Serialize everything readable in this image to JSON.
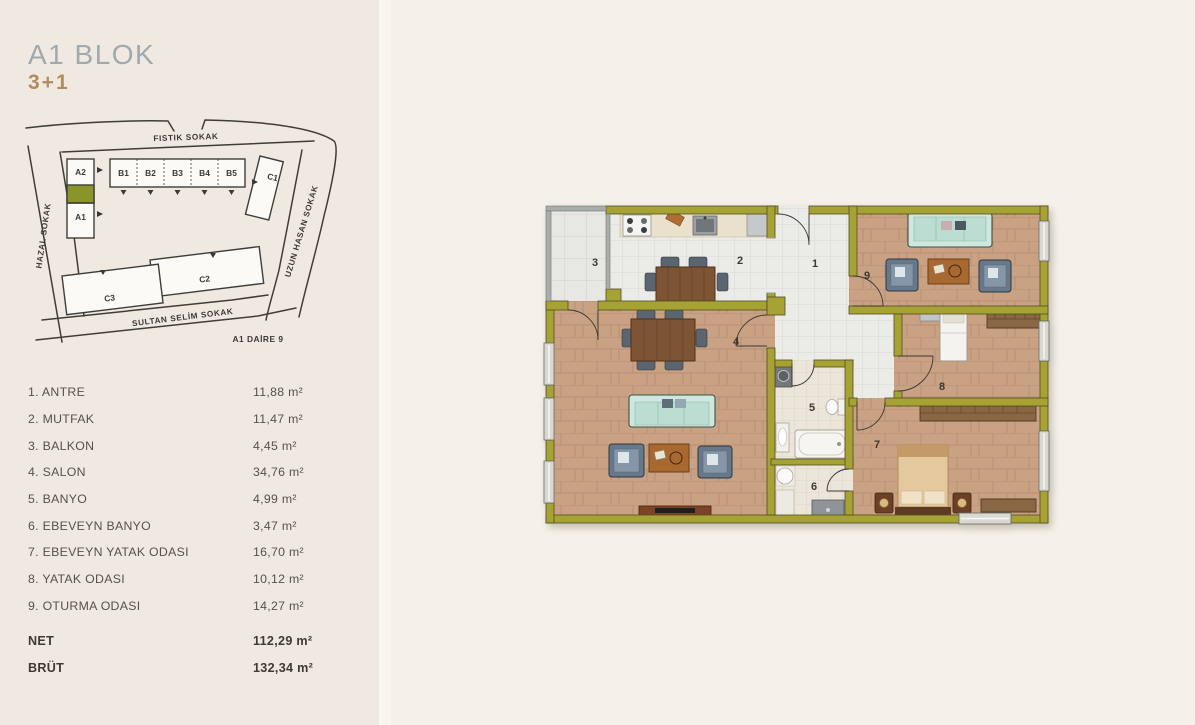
{
  "header": {
    "block_title": "A1 BLOK",
    "unit_type": "3+1"
  },
  "site_map": {
    "caption": "A1 DAİRE 9",
    "streets": {
      "top": "FISTIK SOKAK",
      "left": "HAZAL SOKAK",
      "right": "UZUN HASAN SOKAK",
      "bottom": "SULTAN SELİM SOKAK"
    },
    "blocks": {
      "a2": "A2",
      "a1": "A1",
      "b1": "B1",
      "b2": "B2",
      "b3": "B3",
      "b4": "B4",
      "b5": "B5",
      "c1": "C1",
      "c2": "C2",
      "c3": "C3"
    },
    "highlight_color": "#8a9428"
  },
  "room_list": [
    {
      "label": "1. ANTRE",
      "area": "11,88 m²"
    },
    {
      "label": "2. MUTFAK",
      "area": "11,47 m²"
    },
    {
      "label": "3. BALKON",
      "area": "4,45 m²"
    },
    {
      "label": "4. SALON",
      "area": "34,76 m²"
    },
    {
      "label": "5. BANYO",
      "area": "4,99 m²"
    },
    {
      "label": "6. EBEVEYN BANYO",
      "area": "3,47 m²"
    },
    {
      "label": "7. EBEVEYN YATAK ODASI",
      "area": "16,70 m²"
    },
    {
      "label": "8. YATAK ODASI",
      "area": "10,12 m²"
    },
    {
      "label": "9. OTURMA ODASI",
      "area": "14,27 m²"
    }
  ],
  "totals": {
    "net_label": "NET",
    "net_area": "112,29 m²",
    "brut_label": "BRÜT",
    "brut_area": "132,34 m²"
  },
  "floor_plan": {
    "room_numbers": {
      "r1": "1",
      "r2": "2",
      "r3": "3",
      "r4": "4",
      "r5": "5",
      "r6": "6",
      "r7": "7",
      "r8": "8",
      "r9": "9"
    },
    "wall_color": "#a6a233"
  }
}
